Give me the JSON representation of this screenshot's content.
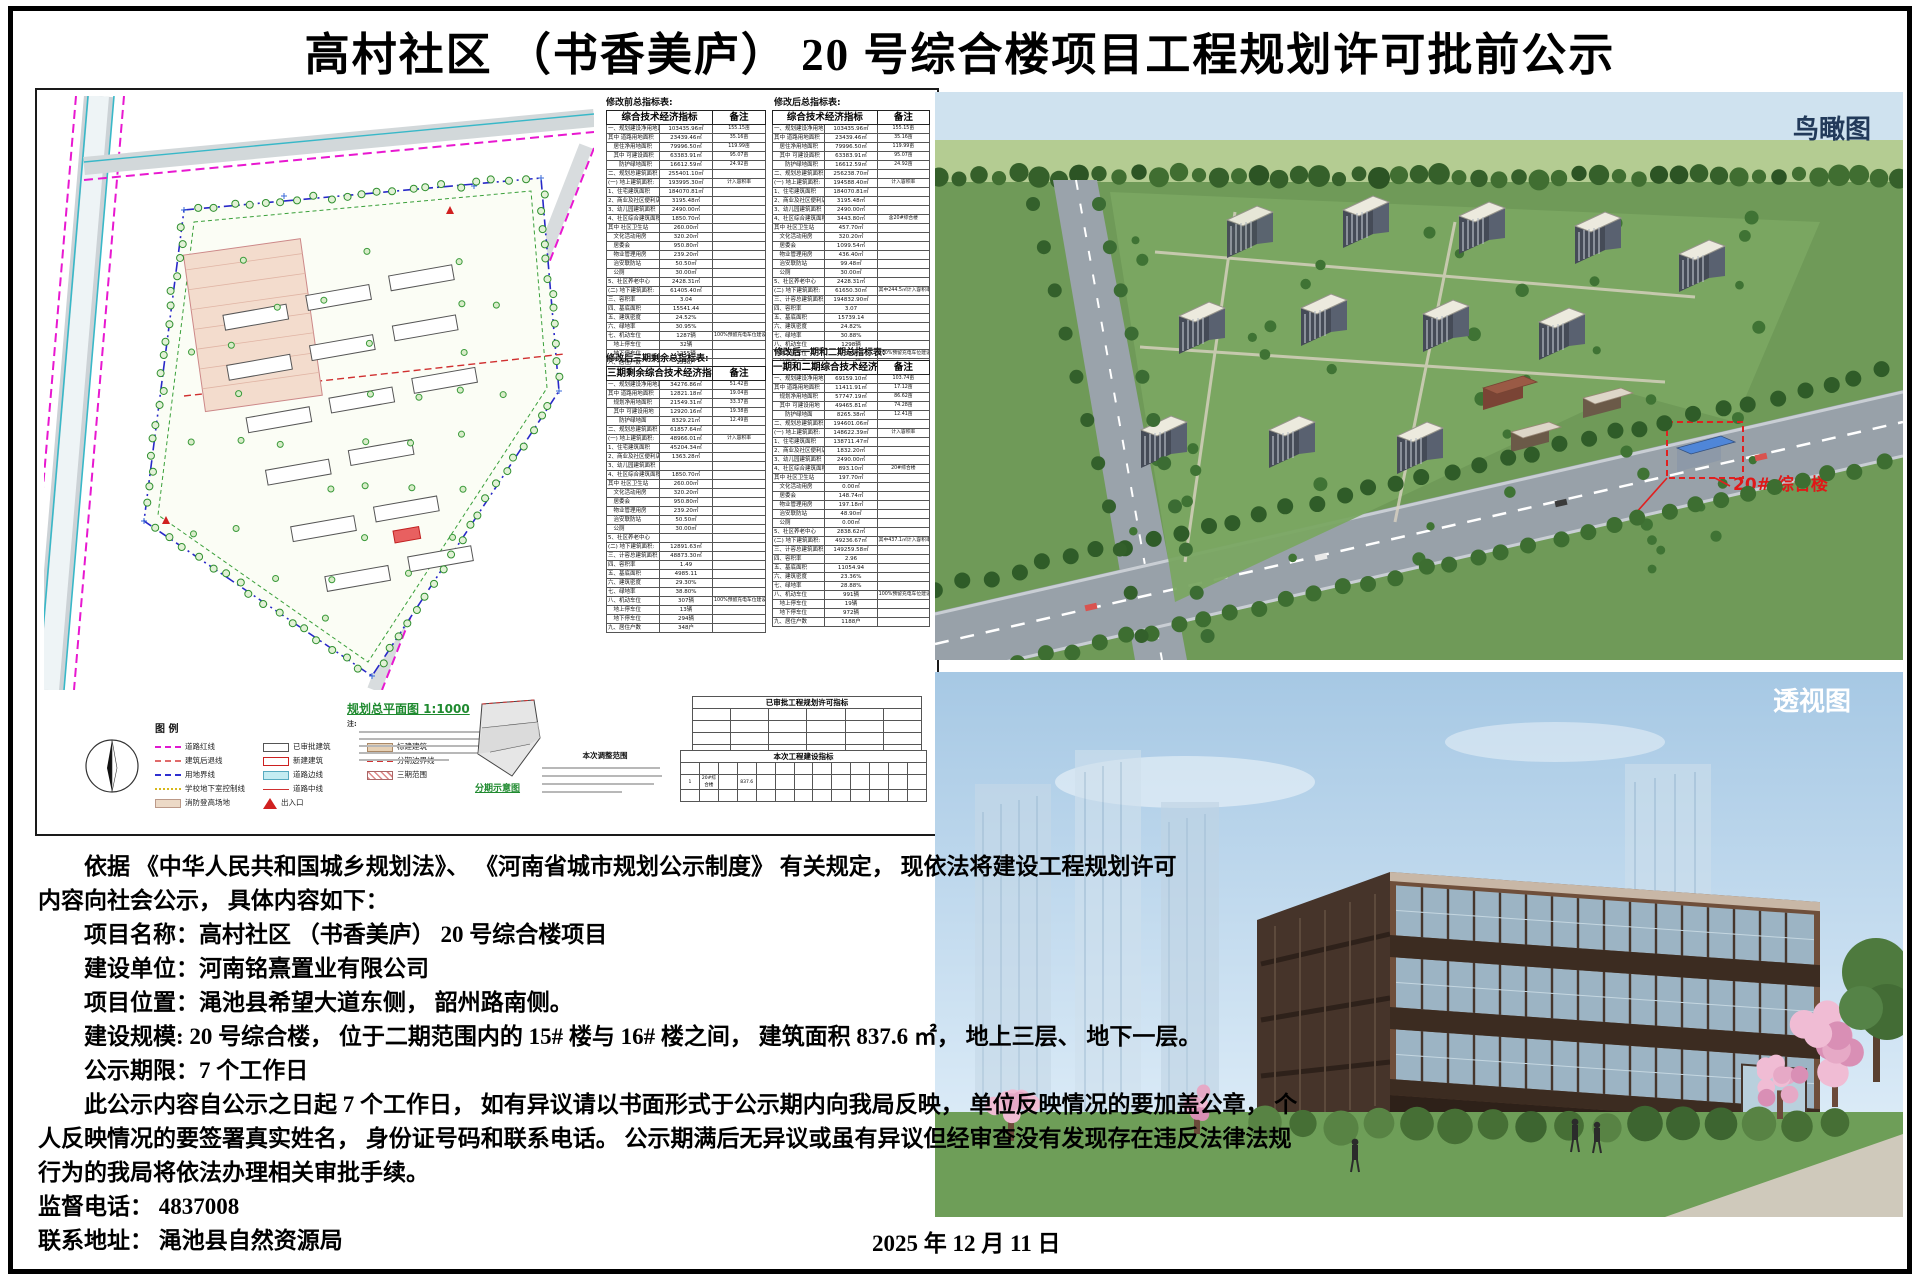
{
  "title": "高村社区 （书香美庐） 20 号综合楼项目工程规划许可批前公示",
  "plan_panel": {
    "captions": {
      "before": "修改前总指标表:",
      "after": "修改后总指标表:",
      "phase3": "修改后三期剩余总指标表:",
      "phase12": "修改后一期和二期总指标表:"
    },
    "tables": {
      "before": {
        "header": [
          [
            "综合技术经济指标",
            2
          ],
          [
            "备注",
            1
          ]
        ],
        "rows": [
          [
            "一、规划建设净用地面积:",
            "103435.96㎡",
            "155.15亩"
          ],
          [
            "其中 道路用地面积",
            "23439.46㎡",
            "35.16亩"
          ],
          [
            "　居住净用地面积",
            "79996.50㎡",
            "119.99亩"
          ],
          [
            "　其中 可建设面积",
            "63383.91㎡",
            "95.07亩"
          ],
          [
            "　　防护绿地面积",
            "16612.59㎡",
            "24.92亩"
          ],
          [
            "二、规划总建筑面积",
            "255401.10㎡",
            ""
          ],
          [
            "(一) 地上建筑面积:",
            "193995.30㎡",
            "计入容积率"
          ],
          [
            "1、住宅建筑面积",
            "184070.81㎡",
            ""
          ],
          [
            "2、商业及社区便利店面积",
            "3195.48㎡",
            ""
          ],
          [
            "3、幼儿园建筑面积",
            "2490.00㎡",
            ""
          ],
          [
            "4、社区综合建筑面积",
            "1850.70㎡",
            ""
          ],
          [
            "其中 社区卫生站",
            "260.00㎡",
            ""
          ],
          [
            "　文化活动用房",
            "320.20㎡",
            ""
          ],
          [
            "　居委会",
            "950.80㎡",
            ""
          ],
          [
            "　物业管理用房",
            "239.20㎡",
            ""
          ],
          [
            "　治安联防站",
            "50.50㎡",
            ""
          ],
          [
            "　公厕",
            "30.00㎡",
            ""
          ],
          [
            "5、社区养老中心",
            "2428.31㎡",
            ""
          ],
          [
            "(二) 地下建筑面积:",
            "61405.40㎡",
            ""
          ],
          [
            "三、容积率",
            "3.04",
            ""
          ],
          [
            "四、基底面积",
            "15541.44",
            ""
          ],
          [
            "五、建筑密度",
            "24.52%",
            ""
          ],
          [
            "六、绿地率",
            "30.95%",
            ""
          ],
          [
            "七、机动车位",
            "1287辆",
            "100%预留充电车位建设安装条件"
          ],
          [
            "　地上停车位",
            "32辆",
            ""
          ],
          [
            "　地下停车位",
            "1255辆",
            ""
          ],
          [
            "八、居住户数",
            "1536户",
            ""
          ]
        ]
      },
      "after": {
        "header": [
          [
            "综合技术经济指标",
            2
          ],
          [
            "备注",
            1
          ]
        ],
        "rows": [
          [
            "一、规划建设净用地面积",
            "103435.96㎡",
            "155.15亩"
          ],
          [
            "其中 道路用地面积",
            "23439.46㎡",
            "35.16亩"
          ],
          [
            "　居住净用地面积",
            "79996.50㎡",
            "119.99亩"
          ],
          [
            "　其中 可建设面积",
            "63383.91㎡",
            "95.07亩"
          ],
          [
            "　　防护绿地面积",
            "16612.59㎡",
            "24.92亩"
          ],
          [
            "二、规划总建筑面积",
            "256238.70㎡",
            ""
          ],
          [
            "(一) 地上建筑面积:",
            "194588.40㎡",
            "计入容积率"
          ],
          [
            "1、住宅建筑面积",
            "184070.81㎡",
            ""
          ],
          [
            "2、商业及社区便利店面积",
            "3195.48㎡",
            ""
          ],
          [
            "3、幼儿园建筑面积",
            "2490.00㎡",
            ""
          ],
          [
            "4、社区综合建筑面积",
            "3443.80㎡",
            "含20#综合楼"
          ],
          [
            "其中 社区卫生站",
            "457.70㎡",
            ""
          ],
          [
            "　文化活动用房",
            "320.20㎡",
            ""
          ],
          [
            "　居委会",
            "1099.54㎡",
            ""
          ],
          [
            "　物业管理用房",
            "436.40㎡",
            ""
          ],
          [
            "　治安联防站",
            "99.48㎡",
            ""
          ],
          [
            "　公厕",
            "30.00㎡",
            ""
          ],
          [
            "5、社区养老中心",
            "2428.31㎡",
            ""
          ],
          [
            "(二) 地下建筑面积:",
            "61650.30㎡",
            "其中244.5㎡计入容积率"
          ],
          [
            "三、计容总建筑面积",
            "194832.90㎡",
            ""
          ],
          [
            "四、容积率",
            "3.07",
            ""
          ],
          [
            "五、基底面积",
            "15739.14",
            ""
          ],
          [
            "六、建筑密度",
            "24.82%",
            ""
          ],
          [
            "七、绿地率",
            "30.88%",
            ""
          ],
          [
            "八、机动车位",
            "1298辆",
            ""
          ],
          [
            "　地上停车位",
            "32辆",
            "100%预留充电车位建设安装条件"
          ],
          [
            "　地下停车位",
            "1258辆",
            ""
          ],
          [
            "九、居住户数",
            "1536户",
            ""
          ]
        ]
      },
      "phase3": {
        "header": [
          [
            "三期剩余综合技术经济指标",
            2
          ],
          [
            "备注",
            1
          ]
        ],
        "rows": [
          [
            "一、规划建设净用地面积:",
            "34276.86㎡",
            "51.42亩"
          ],
          [
            "其中 道路用地面积",
            "12821.18㎡",
            "19.04亩"
          ],
          [
            "　规划净用地面积",
            "21549.31㎡",
            "33.37亩"
          ],
          [
            "　其中 可建设用地",
            "12920.16㎡",
            "19.38亩"
          ],
          [
            "　　防护绿地面",
            "8329.21㎡",
            "12.49亩"
          ],
          [
            "二、规划总建筑面积",
            "61857.64㎡",
            ""
          ],
          [
            "(一) 地上建筑面积:",
            "48966.01㎡",
            "计入容积率"
          ],
          [
            "1、住宅建筑面积",
            "45204.34㎡",
            ""
          ],
          [
            "2、商业及社区便利店面积",
            "1363.28㎡",
            ""
          ],
          [
            "3、幼儿园建筑面积",
            "",
            ""
          ],
          [
            "4、社区综合建筑面积",
            "1850.70㎡",
            ""
          ],
          [
            "其中 社区卫生站",
            "260.00㎡",
            ""
          ],
          [
            "　文化活动用房",
            "320.20㎡",
            ""
          ],
          [
            "　居委会",
            "950.80㎡",
            ""
          ],
          [
            "　物业管理用房",
            "239.20㎡",
            ""
          ],
          [
            "　治安联防站",
            "50.50㎡",
            ""
          ],
          [
            "　公厕",
            "30.00㎡",
            ""
          ],
          [
            "5、社区养老中心",
            "",
            ""
          ],
          [
            "(二) 地下建筑面积:",
            "12891.63㎡",
            ""
          ],
          [
            "三、计容总建筑面积",
            "48873.30㎡",
            ""
          ],
          [
            "四、容积率",
            "1.49",
            ""
          ],
          [
            "五、基底面积",
            "4985.11",
            ""
          ],
          [
            "六、建筑密度",
            "29.30%",
            ""
          ],
          [
            "七、绿地率",
            "38.80%",
            ""
          ],
          [
            "八、机动车位",
            "307辆",
            "100%预留充电车位建设安装条件"
          ],
          [
            "　地上停车位",
            "13辆",
            ""
          ],
          [
            "　地下停车位",
            "294辆",
            ""
          ],
          [
            "九、居住户数",
            "348户",
            ""
          ]
        ]
      },
      "phase12": {
        "header": [
          [
            "一期和二期综合技术经济指标",
            2
          ],
          [
            "备注",
            1
          ]
        ],
        "rows": [
          [
            "一、规划建设净用地面积:",
            "69159.10㎡",
            "103.74亩"
          ],
          [
            "其中 道路用地面积",
            "11411.91㎡",
            "17.12亩"
          ],
          [
            "　规划净用地面积",
            "57747.19㎡",
            "86.62亩"
          ],
          [
            "　其中 可建设用地",
            "49465.81㎡",
            "74.28亩"
          ],
          [
            "　　防护绿地面",
            "8265.38㎡",
            "12.41亩"
          ],
          [
            "二、规划总建筑面积",
            "194601.06㎡",
            ""
          ],
          [
            "(一) 地上建筑面积:",
            "148622.39㎡",
            "计入容积率"
          ],
          [
            "1、住宅建筑面积",
            "138711.47㎡",
            ""
          ],
          [
            "2、商业及社区便利店面积",
            "1832.20㎡",
            ""
          ],
          [
            "3、幼儿园建筑面积",
            "2490.00㎡",
            ""
          ],
          [
            "4、社区综合建筑面积",
            "893.10㎡",
            "20#综合楼"
          ],
          [
            "其中 社区卫生站",
            "197.70㎡",
            ""
          ],
          [
            "　文化活动用房",
            "0.00㎡",
            ""
          ],
          [
            "　居委会",
            "148.74㎡",
            ""
          ],
          [
            "　物业管理用房",
            "197.18㎡",
            ""
          ],
          [
            "　治安联防站",
            "48.90㎡",
            ""
          ],
          [
            "　公厕",
            "0.00㎡",
            ""
          ],
          [
            "5、社区养老中心",
            "2838.62㎡",
            ""
          ],
          [
            "(二) 地下建筑面积:",
            "49236.67㎡",
            "其中437.1㎡计入容积率"
          ],
          [
            "三、计容总建筑面积",
            "149259.58㎡",
            ""
          ],
          [
            "四、容积率",
            "2.96",
            ""
          ],
          [
            "五、基底面积",
            "11054.94",
            ""
          ],
          [
            "六、建筑密度",
            "23.36%",
            ""
          ],
          [
            "七、绿地率",
            "28.88%",
            ""
          ],
          [
            "八、机动车位",
            "991辆",
            "100%预留充电车位建设安装条件"
          ],
          [
            "　地上停车位",
            "19辆",
            ""
          ],
          [
            "　地下停车位",
            "972辆",
            ""
          ],
          [
            "九、居住户数",
            "1188户",
            ""
          ]
        ]
      },
      "approved": {
        "title": "已审批工程规划许可指标",
        "rows": [
          [
            "",
            "",
            "",
            "",
            "",
            ""
          ],
          [
            "",
            "",
            "",
            "",
            "",
            ""
          ],
          [
            "",
            "",
            "",
            "",
            "",
            ""
          ],
          [
            "",
            "",
            "",
            "",
            "",
            ""
          ]
        ]
      },
      "current": {
        "title": "本次工程建设指标",
        "rows": [
          [
            "",
            "",
            "",
            "",
            "",
            "",
            "",
            "",
            "",
            "",
            "",
            "",
            ""
          ],
          [
            "1",
            "20#综合楼",
            "",
            "837.6",
            "",
            "",
            "",
            "",
            "",
            "",
            "",
            "",
            ""
          ],
          [
            "",
            "",
            "",
            "",
            "",
            "",
            "",
            "",
            "",
            "",
            "",
            "",
            ""
          ]
        ]
      }
    },
    "legend_title": "图 例",
    "legend": {
      "col1": [
        {
          "sw": "dash-magenta",
          "label": "道路红线"
        },
        {
          "sw": "dash-red",
          "label": "建筑后退线"
        },
        {
          "sw": "dash-blue",
          "label": "用地界线"
        },
        {
          "sw": "dash-yellow",
          "label": "学校地下室控制线"
        },
        {
          "sw": "fill-tan",
          "label": "消防登高场地"
        }
      ],
      "col2": [
        {
          "sw": "box-outline",
          "label": "已审批建筑"
        },
        {
          "sw": "box-red",
          "label": "新建建筑"
        },
        {
          "sw": "fill-cyan",
          "label": "道路边线"
        },
        {
          "sw": "line-red",
          "label": "道路中线"
        },
        {
          "sw": "tri-red",
          "label": "出入口"
        }
      ],
      "col3": [
        {
          "sw": "fill-tan2",
          "label": "标建建筑"
        },
        {
          "sw": "dash-red2",
          "label": "分期边界线"
        },
        {
          "sw": "hatch",
          "label": "三期范围"
        }
      ]
    },
    "plan_title": "规划总平面图 1:1000",
    "notes_label": "注:",
    "phase_diagram_label": "分期示意图",
    "adjust_scope_title": "本次调整范围"
  },
  "views": {
    "aerial_label": "鸟瞰图",
    "perspective_label": "透视图",
    "callout": "20# 综合楼"
  },
  "notice": {
    "lines": [
      "　　依据 《中华人民共和国城乡规划法》、 《河南省城市规划公示制度》 有关规定， 现依法将建设工程规划许可",
      "内容向社会公示， 具体内容如下：",
      "　　项目名称：高村社区 （书香美庐） 20 号综合楼项目",
      "　　建设单位：河南铭熹置业有限公司",
      "　　项目位置：渑池县希望大道东侧， 韶州路南侧。",
      "　　建设规模: 20 号综合楼， 位于二期范围内的 15# 楼与 16# 楼之间， 建筑面积 837.6 ㎡， 地上三层、 地下一层。",
      "　　公示期限：7 个工作日",
      "　　此公示内容自公示之日起 7 个工作日， 如有异议请以书面形式于公示期内向我局反映， 单位反映情况的要加盖公章， 个",
      "人反映情况的要签署真实姓名， 身份证号码和联系电话。 公示期满后无异议或虽有异议但经审查没有发现存在违反法律法规",
      "行为的我局将依法办理相关审批手续。",
      "监督电话： 4837008",
      "联系地址： 渑池县自然资源局"
    ],
    "date": "2025 年 12 月 11 日"
  }
}
